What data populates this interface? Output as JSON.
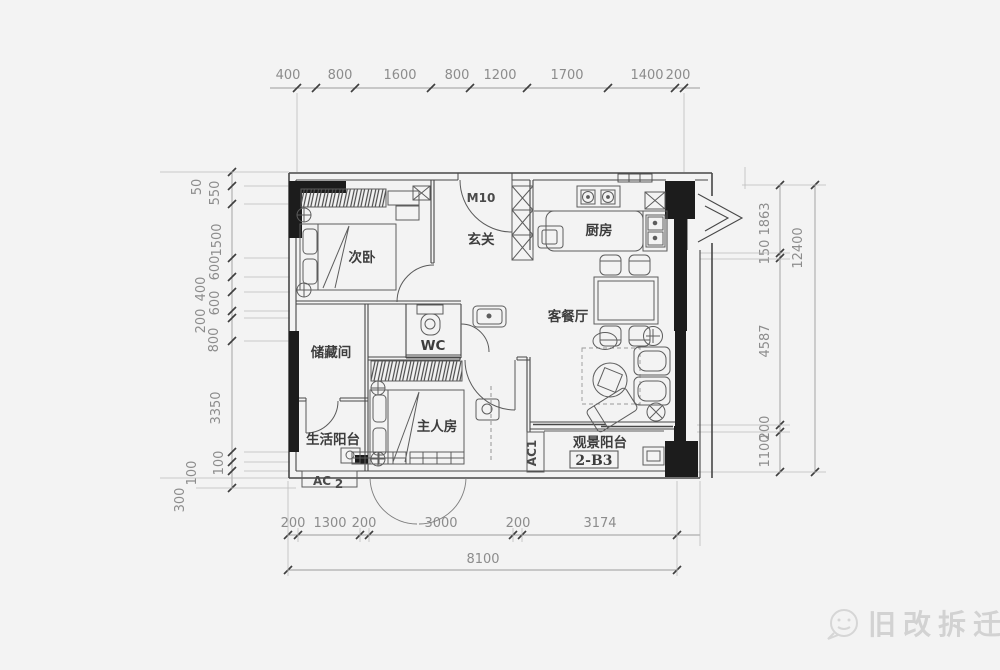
{
  "drawing": {
    "rooms": {
      "bedroom2": "次卧",
      "entry": "玄关",
      "kitchen": "厨房",
      "living_dining": "客餐厅",
      "wc": "WC",
      "storage": "储藏间",
      "master_bedroom": "主人房",
      "life_balcony": "生活阳台",
      "view_balcony": "观景阳台"
    },
    "codes": {
      "entry_door": "M10",
      "unit": "2-B3",
      "ac_balcony": "AC1",
      "ac_platform": "AC",
      "ac_platform_sub": "2"
    }
  },
  "dimensions": {
    "top": [
      "400",
      "800",
      "1600",
      "800",
      "1200",
      "1700",
      "1400",
      "200"
    ],
    "bottom": [
      "200",
      "1300",
      "200",
      "3000",
      "200",
      "3174"
    ],
    "bottom_total": "8100",
    "left": [
      "50",
      "550",
      "1500",
      "600",
      "400",
      "600",
      "200",
      "800",
      "3350",
      "100",
      "100",
      "300"
    ],
    "right": [
      "1863",
      "150",
      "4587",
      "200",
      "1100"
    ],
    "right_total": "12400"
  },
  "watermark": {
    "text": "旧改拆迁"
  },
  "icons": {
    "watermark_logo": "chat-bubble"
  },
  "colors": {
    "wall": "#474747",
    "black_fill": "#1c1c1c",
    "dim_text": "#8c8c8c",
    "dim_line": "#9b9b9b",
    "watermark": "#d2d2d2"
  }
}
